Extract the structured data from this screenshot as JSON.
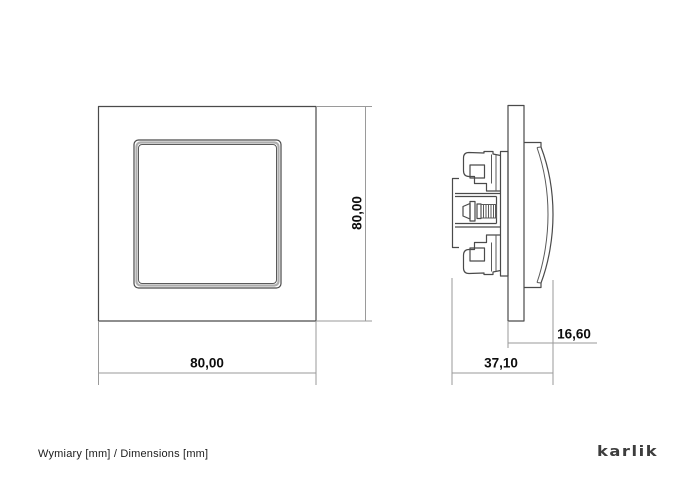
{
  "drawing": {
    "front_view": {
      "label": "front view of single switch with frame",
      "width_label": "80,00",
      "height_label": "80,00"
    },
    "side_view": {
      "label": "side profile of switch mechanism",
      "total_depth_label": "37,10",
      "front_depth_label": "16,60"
    }
  },
  "footer": {
    "caption": "Wymiary [mm] / Dimensions [mm]",
    "brand_logo": "karlik"
  },
  "colors": {
    "background": "#ffffff",
    "line": "#4a4a4a",
    "dimension_line": "#9a9a9a",
    "text": "#0d0d0d",
    "brand_text": "#3d3d3d"
  }
}
